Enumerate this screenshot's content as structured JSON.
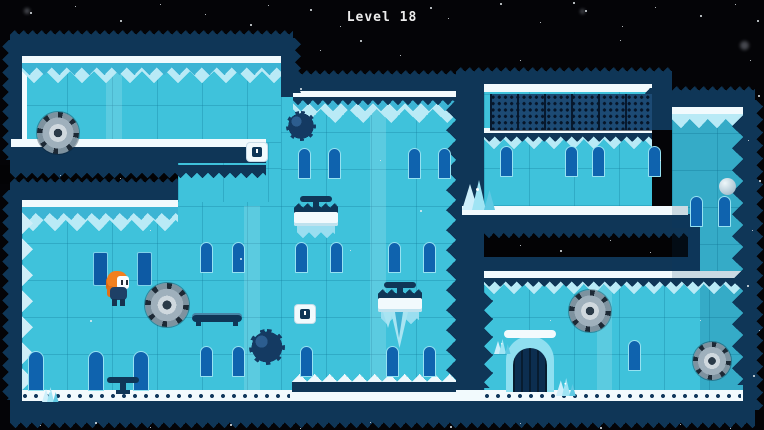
{
  "hud": {
    "level_label": "Level 18"
  },
  "palette": {
    "space_black": "#040407",
    "ice_base": "#3fc2db",
    "ice_highlight": "#b9eaf6",
    "wall_navy": "#0f3657",
    "snow_white": "#f2fafd",
    "window_blue": "#0f63ae",
    "saw_gray": "#9fb0bc",
    "player_orange": "#f2801e"
  },
  "game": {
    "entities": {
      "player": {
        "cx": 119,
        "cy": 289
      },
      "saw_blades": [
        {
          "cx": 58,
          "cy": 133,
          "r": 21
        },
        {
          "cx": 167,
          "cy": 305,
          "r": 22
        },
        {
          "cx": 590,
          "cy": 311,
          "r": 21
        },
        {
          "cx": 712,
          "cy": 361,
          "r": 19
        }
      ],
      "spike_balls": [
        {
          "cx": 301,
          "cy": 126,
          "r": 15
        },
        {
          "cx": 267,
          "cy": 347,
          "r": 18
        }
      ],
      "spike_platforms": [
        {
          "cx": 316,
          "top": 196,
          "icicle": "small"
        },
        {
          "cx": 400,
          "top": 282,
          "icicle": "large"
        }
      ],
      "floor_valve": {
        "cx": 123,
        "top": 377
      },
      "moving_platform": {
        "x": 192,
        "y": 313,
        "w": 50
      },
      "marker_blocks": [
        {
          "cx": 257,
          "cy": 152
        },
        {
          "cx": 305,
          "cy": 314
        }
      ],
      "exit_door": {
        "cx": 530
      },
      "ice_crystals": [
        {
          "x": 462,
          "y": 180,
          "s": 1
        },
        {
          "x": 494,
          "y": 324,
          "s": 0.5
        },
        {
          "x": 556,
          "y": 366,
          "s": 0.6
        },
        {
          "x": 42,
          "y": 372,
          "s": 0.5
        }
      ],
      "ice_ball": {
        "cx": 727,
        "cy": 186
      }
    }
  }
}
